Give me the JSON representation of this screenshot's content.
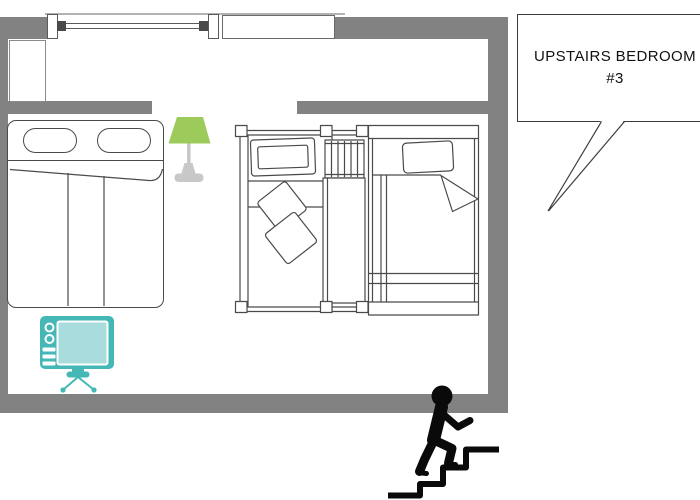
{
  "title": "Upstairs bedroom floor plan",
  "callout": {
    "line1": "UPSTAIRS BEDROOM",
    "line2": "#3"
  },
  "colors": {
    "wall": "#828282",
    "outline": "#4a4a4a",
    "lamp_shade": "#9ccb5b",
    "lamp_base": "#c8c8c8",
    "tv_body": "#45b7b7",
    "tv_screen": "#a9dddd",
    "figure": "#0a0a0a",
    "callout_border": "#3c3c3c"
  },
  "objects": {
    "double_bed": "double bed with two pillows",
    "single_bed_left": "single bed with two cushions",
    "single_bed_right": "single bed with folded blanket",
    "bunk_ladder": "bunk-bed ladder",
    "table_lamp": "table lamp",
    "tv": "television on stand",
    "cabinet": "cabinet",
    "window_casement": "casement window",
    "window_plain": "window",
    "stair_figure": "person climbing stairs"
  }
}
